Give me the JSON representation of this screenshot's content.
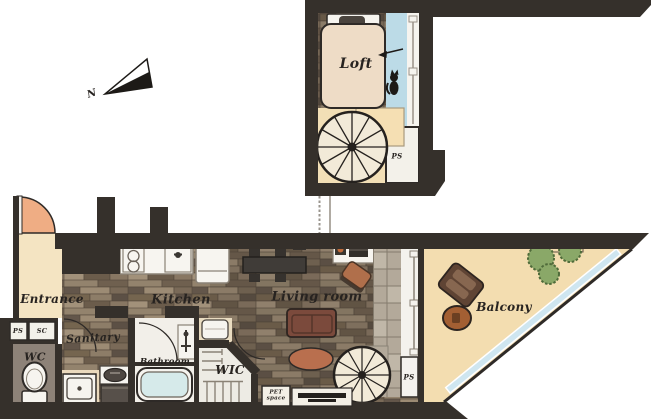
{
  "plan": {
    "title": "One-room loft apartment floor plan",
    "labels": {
      "loft": "Loft",
      "loft_ps": "PS",
      "entrance": "Entrance",
      "kitchen": "Kitchen",
      "living_room": "Living room",
      "ps_shaft_left": "PS",
      "sc_shaft": "SC",
      "wc": "WC",
      "sanitary": "Sanitary",
      "bathroom": "Bathroom",
      "wic": "WIC",
      "pet_space": "PET space",
      "ps_shaft_right": "PS",
      "balcony": "Balcony",
      "north": "N"
    },
    "colors": {
      "wall": "#35302b",
      "wood_floor": "#857565",
      "cream_floor": "#f2e0bb",
      "entrance_floor": "#f4e4c2",
      "balcony_floor": "#f3ddb0",
      "blue_glass": "#bcdbe7",
      "white_fixture": "#f6f4ef",
      "tile_strip": "#b3a99a",
      "sofa": "#7b4a3c",
      "rug": "#b96f4e",
      "door_swing": "#efad84",
      "plant_green": "#8aa868",
      "tub_water": "#d6eaea"
    },
    "furniture_icons": [
      "bed",
      "spiral-staircase",
      "kitchen-counter",
      "stove",
      "kitchen-sink",
      "refrigerator",
      "dining-table",
      "dining-chair",
      "desk",
      "laptop",
      "office-chair",
      "sofa",
      "rug",
      "tv-board",
      "toilet",
      "washing-machine",
      "vanity-sink",
      "bathtub",
      "clothes-rack",
      "storage-chest",
      "balcony-armchair",
      "balcony-table",
      "plants",
      "cat",
      "north-arrow",
      "door-swing",
      "railing"
    ]
  }
}
